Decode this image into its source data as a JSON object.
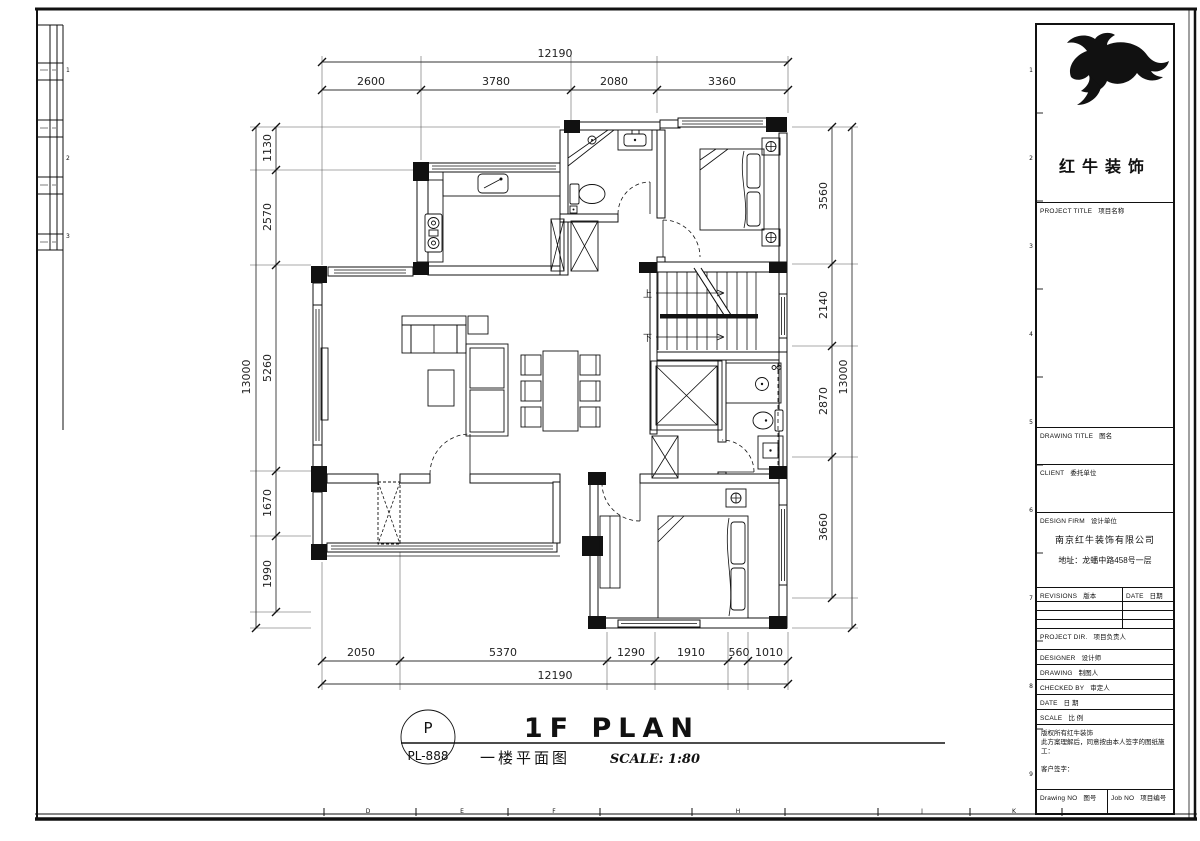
{
  "sheet": {
    "grid_letters": [
      "D",
      "E",
      "F",
      "H",
      "J",
      "K"
    ],
    "grid_numbers": [
      "1",
      "2",
      "3",
      "4",
      "5",
      "6",
      "7",
      "8",
      "9"
    ],
    "grid_numbers_left": [
      "1",
      "2",
      "3"
    ]
  },
  "title_bar": {
    "code_letter": "P",
    "sheet_no": "PL-888",
    "title_en": "1F PLAN",
    "title_cn": "一楼平面图",
    "scale_text": "SCALE: 1:80"
  },
  "title_block": {
    "logo_name": "红牛装饰",
    "project_title_en": "PROJECT TITLE",
    "project_title_cn": "项目名称",
    "drawing_title_en": "DRAWING TITLE",
    "drawing_title_cn": "图名",
    "client_en": "CLIENT",
    "client_cn": "委托单位",
    "design_firm_en": "DESIGN FIRM",
    "design_firm_cn": "设计单位",
    "firm_name": "南京红牛装饰有限公司",
    "firm_address": "地址：龙蟠中路458号一层",
    "revisions_en": "REVISIONS",
    "revisions_cn": "版本",
    "rev_date_en": "DATE",
    "rev_date_cn": "日期",
    "project_dir_en": "PROJECT DIR.",
    "project_dir_cn": "项目负责人",
    "designer_en": "DESIGNER",
    "designer_cn": "设计师",
    "drawing_by_en": "DRAWING",
    "drawing_by_cn": "制图人",
    "checked_by_en": "CHECKED BY",
    "checked_by_cn": "审定人",
    "date_en": "DATE",
    "date_cn": "日 期",
    "scale_en": "SCALE",
    "scale_cn": "比 例",
    "copyright_line": "版权所有红牛装饰",
    "agreement_line": "此方案理解后，同意按由本人签字的图纸施工：",
    "signature_line": "客户签字：",
    "drawing_no_en": "Drawing NO",
    "drawing_no_cn": "图号",
    "job_no_en": "Job NO",
    "job_no_cn": "项目编号"
  },
  "dimensions": {
    "top": {
      "overall": "12190",
      "segments": [
        "2600",
        "3780",
        "2080",
        "3360"
      ]
    },
    "bottom": {
      "overall": "12190",
      "segments": [
        "2050",
        "5370",
        "1290",
        "1910",
        "560",
        "1010"
      ]
    },
    "left": {
      "overall": "13000",
      "segments": [
        "1130",
        "2570",
        "5260",
        "1670",
        "1990"
      ]
    },
    "right": {
      "overall": "13000",
      "segments": [
        "3560",
        "2140",
        "2870",
        "3660"
      ]
    }
  },
  "plan": {
    "stairs_up": "上",
    "stairs_down": "下"
  }
}
